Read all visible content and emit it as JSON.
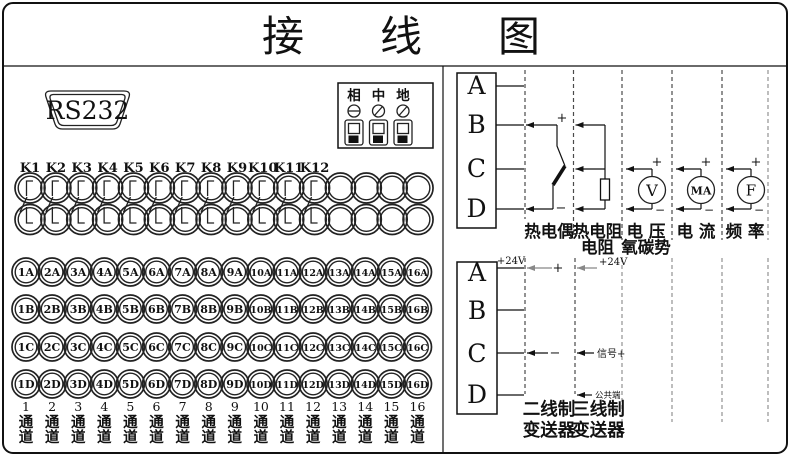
{
  "title": "接线图",
  "left_panel": {
    "rs232_label": "RS232",
    "power_block": {
      "labels": [
        "相",
        "中",
        "地"
      ]
    },
    "relay_labels": [
      "K1",
      "K2",
      "K3",
      "K4",
      "K5",
      "K6",
      "K7",
      "K8",
      "K9",
      "K10",
      "K11",
      "K12"
    ],
    "terminal_rows": [
      {
        "labels": [
          "1A",
          "2A",
          "3A",
          "4A",
          "5A",
          "6A",
          "7A",
          "8A",
          "9A",
          "10A",
          "11A",
          "12A",
          "13A",
          "14A",
          "15A",
          "16A"
        ]
      },
      {
        "labels": [
          "1B",
          "2B",
          "3B",
          "4B",
          "5B",
          "6B",
          "7B",
          "8B",
          "9B",
          "10B",
          "11B",
          "12B",
          "13B",
          "14B",
          "15B",
          "16B"
        ]
      },
      {
        "labels": [
          "1C",
          "2C",
          "3C",
          "4C",
          "5C",
          "6C",
          "7C",
          "8C",
          "9C",
          "10C",
          "11C",
          "12C",
          "13C",
          "14C",
          "15C",
          "16C"
        ]
      },
      {
        "labels": [
          "1D",
          "2D",
          "3D",
          "4D",
          "5D",
          "6D",
          "7D",
          "8D",
          "9D",
          "10D",
          "11D",
          "12D",
          "13D",
          "14D",
          "15D",
          "16D"
        ]
      }
    ],
    "channels": {
      "numbers": [
        "1",
        "2",
        "3",
        "4",
        "5",
        "6",
        "7",
        "8",
        "9",
        "10",
        "11",
        "12",
        "13",
        "14",
        "15",
        "16"
      ],
      "word_chars": [
        "通",
        "道"
      ]
    }
  },
  "right_panel": {
    "top": {
      "block_letters": [
        "A",
        "B",
        "C",
        "D"
      ],
      "plus": "+",
      "minus": "−",
      "sections": [
        {
          "label1": "热电偶",
          "label2": ""
        },
        {
          "label1": "热电阻",
          "label2": "电阻"
        },
        {
          "label1": "电 压",
          "label2": "氧碳势",
          "meter": "V"
        },
        {
          "label1": "电 流",
          "label2": "",
          "meter": "MA"
        },
        {
          "label1": "频 率",
          "label2": "",
          "meter": "F"
        }
      ]
    },
    "bottom": {
      "block_letters": [
        "A",
        "B",
        "C",
        "D"
      ],
      "supply_label": "+24V",
      "plus": "+",
      "minus": "−",
      "signal_label": "信号+",
      "common_label": "公共端",
      "sections": [
        {
          "line1": "二线制",
          "line2": "变送器"
        },
        {
          "line1": "三线制",
          "line2": "变送器"
        }
      ]
    }
  }
}
